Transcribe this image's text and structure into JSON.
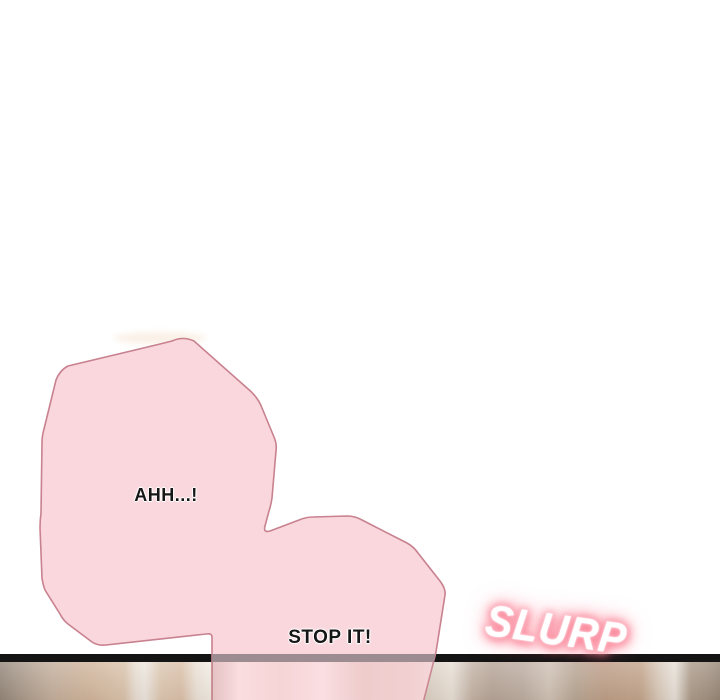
{
  "panel": {
    "background_color": "#ffffff",
    "divider_color": "#141414",
    "divider_through_bubble_color": "#9c8b90"
  },
  "bubbles": {
    "fill_color": "#f9d7dd",
    "stroke_color": "#c8818e",
    "bubble1_text": "AHH...!",
    "bubble2_text": "STOP IT!"
  },
  "sfx": {
    "text": "SLURP",
    "text_color": "#ffffff",
    "glow_color": "#fa7c90"
  },
  "scene": {
    "description_colors": [
      "#8a7d70",
      "#d0b49a",
      "#ece6de",
      "#cbb7a5",
      "#bd9e86",
      "#e8e1d9"
    ]
  }
}
